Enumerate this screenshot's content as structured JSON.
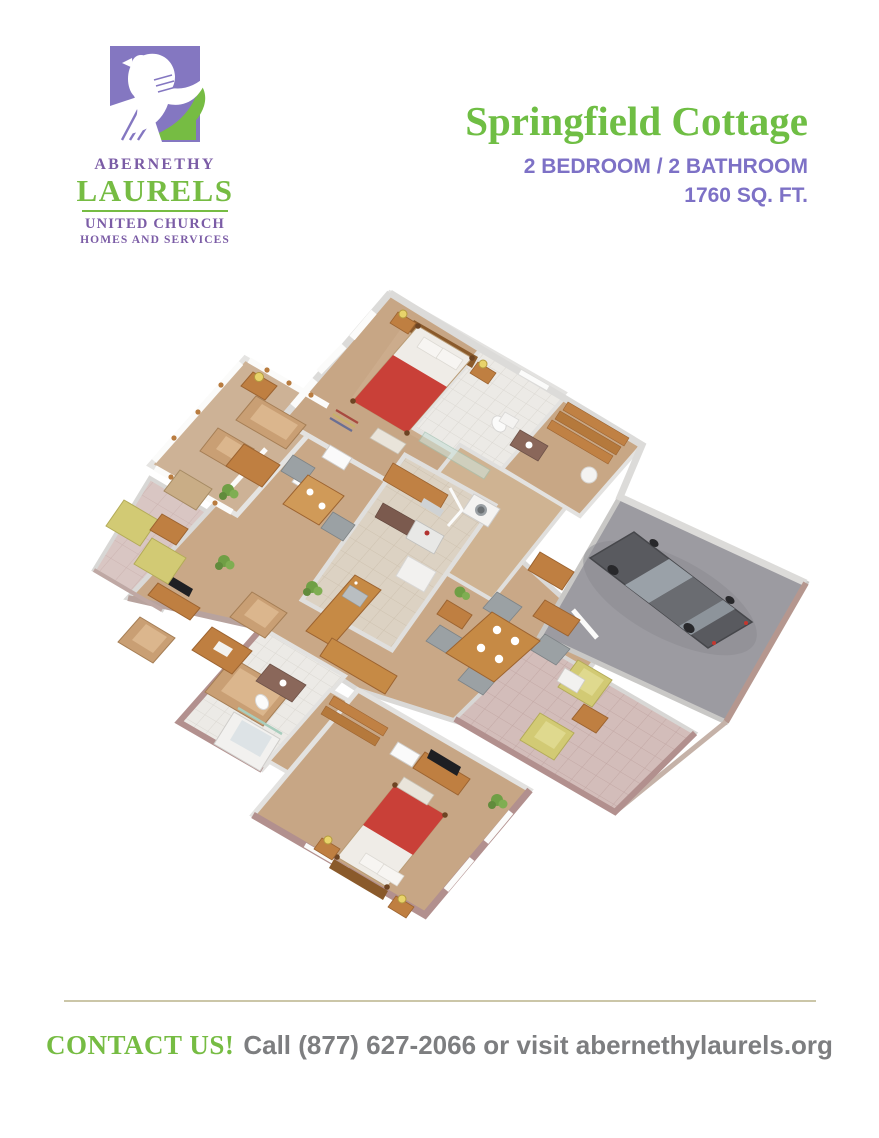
{
  "logo": {
    "name_line1": "ABERNETHY",
    "name_line2": "LAURELS",
    "name_line3": "UNITED CHURCH",
    "name_line4": "HOMES AND SERVICES",
    "purple": "#8477C1",
    "green": "#76BC43",
    "text_purple": "#7B5CA6"
  },
  "header": {
    "title": "Springfield Cottage",
    "spec_line1": "2 BEDROOM / 2 BATHROOM",
    "spec_line2": "1760 SQ. FT.",
    "title_color": "#6FBE44",
    "spec_color": "#7D71C6"
  },
  "floorplan": {
    "type": "3d-isometric-rendering",
    "features": [
      "sunroom",
      "living room",
      "breakfast nook",
      "kitchen",
      "laundry",
      "dining area",
      "master bedroom",
      "master bathroom",
      "walk-in closet",
      "second bedroom",
      "second bathroom",
      "garage with car",
      "covered patio",
      "side patio"
    ],
    "palette": {
      "carpet": "#C9A887",
      "kitchen_tile": "#DCD2C3",
      "bath_tile": "#ECEAE6",
      "garage_floor": "#9C9BA1",
      "patio_brick": "#C2A09D",
      "wood": "#BF7F41",
      "bed_red": "#C94038",
      "sofa_tan": "#C99F74",
      "patio_chair_yellow": "#D2CA74",
      "car_gray": "#5A5B60",
      "wall": "#E2E1DF",
      "exterior_brick": "#B2908E",
      "plant_green": "#6F9F45"
    }
  },
  "footer": {
    "contact_label": "CONTACT US!",
    "contact_text": "Call (877) 627-2066 or visit abernethylaurels.org",
    "label_color": "#76BC43",
    "text_color": "#7D7E80",
    "divider_color": "#CBC6A8"
  }
}
